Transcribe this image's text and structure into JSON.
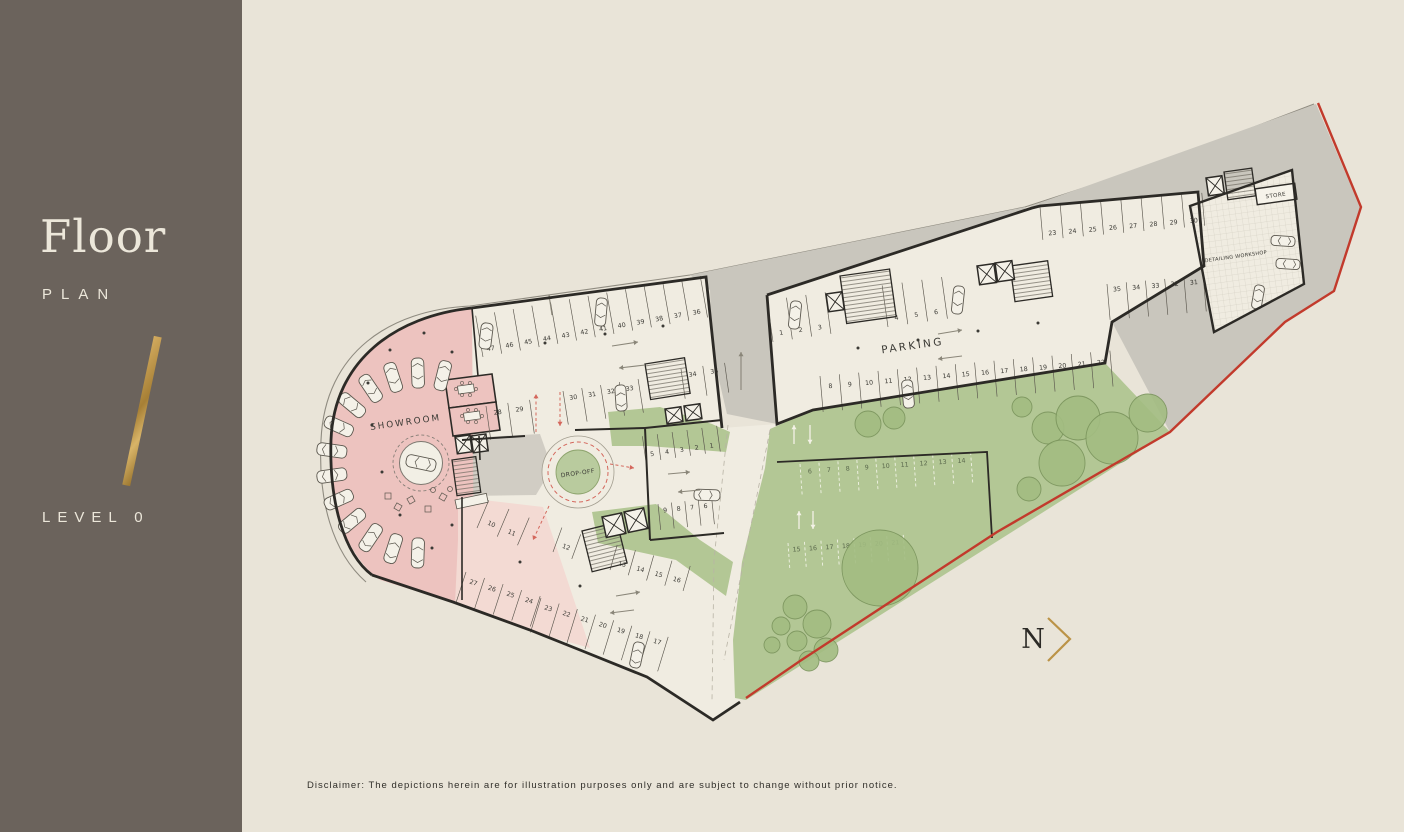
{
  "sidebar": {
    "title": "Floor",
    "subtitle": "PLAN",
    "level": "LEVEL 0"
  },
  "north": {
    "label": "N"
  },
  "disclaimer": "Disclaimer: The depictions herein are for illustration purposes only and are subject to change without prior notice.",
  "colors": {
    "sidebar_bg": "#6b635c",
    "sidebar_text": "#ece7da",
    "gold": "#bb9347",
    "canvas_bg": "#e9e4d8",
    "floor": "#f0ece1",
    "gray_zone": "#c9c6bd",
    "pink_strong": "#edc3bf",
    "pink_light": "#f3dad3",
    "green": "#b3c795",
    "green_island": "#b9cb9e",
    "tree_fill": "#a3bd82",
    "tree_stroke": "#7a945c",
    "wall": "#2c2a26",
    "line": "#5b574e",
    "car_fill": "#f4f1e8",
    "red_boundary": "#c23a2c",
    "red_dash": "#d4675c",
    "label_text": "#3b3a35",
    "arrow_gray": "#8a8679",
    "white_arrow": "#f4f2e7",
    "outdoor_num": "#5a684c",
    "site_line": "#8f8b80"
  },
  "plan": {
    "labels": {
      "showroom": "SHOWROOM",
      "dropoff": "DROP-OFF",
      "parking": "PARKING",
      "store": "STORE",
      "workshop": "DETAILING WORKSHOP"
    },
    "parking_rows": [
      {
        "numbers": [
          "47",
          "46",
          "45",
          "44",
          "43",
          "42",
          "41",
          "40",
          "39",
          "38",
          "37",
          "36"
        ],
        "x": 483,
        "y": 357,
        "angle": -10,
        "spacing": 19,
        "depth": 42,
        "side": -1,
        "inset": 7
      },
      {
        "numbers": [
          "28",
          "29"
        ],
        "x": 486,
        "y": 406,
        "angle": -8,
        "spacing": 22,
        "depth": 34,
        "side": 1,
        "inset": 8
      },
      {
        "numbers": [
          "30",
          "31",
          "32",
          "33"
        ],
        "x": 563,
        "y": 391,
        "angle": -9,
        "spacing": 19,
        "depth": 34,
        "side": 1,
        "inset": 8
      },
      {
        "numbers": [
          "34",
          "35"
        ],
        "x": 681,
        "y": 369,
        "angle": -8,
        "spacing": 22,
        "depth": 30,
        "side": 1,
        "inset": 7
      },
      {
        "numbers": [
          "5",
          "4",
          "3",
          "2",
          "1"
        ],
        "x": 646,
        "y": 462,
        "angle": -8,
        "spacing": 15,
        "depth": 26,
        "side": -1,
        "inset": 7
      },
      {
        "numbers": [
          "9",
          "8",
          "7",
          "6"
        ],
        "x": 658,
        "y": 504,
        "angle": -6,
        "spacing": 13.5,
        "depth": 26,
        "side": 1,
        "inset": 7
      },
      {
        "numbers": [
          "1",
          "2",
          "3"
        ],
        "x": 773,
        "y": 342,
        "angle": -8,
        "spacing": 19.5,
        "depth": 42,
        "side": -1,
        "inset": 8
      },
      {
        "numbers": [
          "4",
          "5",
          "6"
        ],
        "x": 888,
        "y": 327,
        "angle": -8,
        "spacing": 20,
        "depth": 42,
        "side": -1,
        "inset": 8
      },
      {
        "numbers": [
          "8",
          "9",
          "10",
          "11",
          "12",
          "13",
          "14",
          "15",
          "16",
          "17",
          "18",
          "19",
          "20",
          "21",
          "22"
        ],
        "x": 820,
        "y": 376,
        "angle": -5,
        "spacing": 19.4,
        "depth": 36,
        "side": 1,
        "inset": 11
      },
      {
        "numbers": [
          "23",
          "24",
          "25",
          "26",
          "27",
          "28",
          "29",
          "30"
        ],
        "x": 1040,
        "y": 207,
        "angle": -5,
        "spacing": 20.3,
        "depth": 33,
        "side": 1,
        "inset": 27
      },
      {
        "numbers": [
          "35",
          "34",
          "33",
          "32",
          "31"
        ],
        "x": 1107,
        "y": 284,
        "angle": -5,
        "spacing": 19.3,
        "depth": 36,
        "side": 1,
        "inset": 6
      },
      {
        "numbers": [
          "10",
          "11"
        ],
        "x": 477,
        "y": 528,
        "angle": 23,
        "spacing": 22,
        "depth": 30,
        "side": -1,
        "inset": 9
      },
      {
        "numbers": [
          "12"
        ],
        "x": 553,
        "y": 552,
        "angle": 20,
        "spacing": 20,
        "depth": 26,
        "side": -1,
        "inset": 9
      },
      {
        "numbers": [
          "13",
          "14",
          "15",
          "16"
        ],
        "x": 610,
        "y": 570,
        "angle": 16,
        "spacing": 19,
        "depth": 26,
        "side": -1,
        "inset": 9
      },
      {
        "numbers": [
          "27",
          "26",
          "25",
          "24"
        ],
        "x": 466,
        "y": 572,
        "angle": 18,
        "spacing": 19.5,
        "depth": 32,
        "side": 1,
        "inset": 8
      },
      {
        "numbers": [
          "23",
          "22",
          "21",
          "20",
          "19",
          "18",
          "17"
        ],
        "x": 541,
        "y": 598,
        "angle": 17,
        "spacing": 19,
        "depth": 36,
        "side": 1,
        "inset": 8
      }
    ],
    "outdoor_rows": [
      {
        "numbers": [
          "6",
          "7",
          "8",
          "9",
          "10",
          "11",
          "12",
          "13",
          "14"
        ],
        "x": 800,
        "y": 464,
        "angle": -4,
        "spacing": 19,
        "depth": 32,
        "side": 1,
        "inset": 8
      },
      {
        "numbers": [
          "15",
          "16",
          "17",
          "18",
          "19",
          "20",
          "21"
        ],
        "x": 788,
        "y": 543,
        "angle": -4,
        "spacing": 16.5,
        "depth": 26,
        "side": 1,
        "inset": 7
      }
    ],
    "showroom_display": {
      "center": [
        421,
        463
      ],
      "radius": 90,
      "angles": [
        284,
        268,
        252,
        236,
        220,
        204,
        188,
        172,
        156,
        140,
        124,
        108,
        92
      ],
      "turntable_radius": 21.5
    },
    "stall_cars": [
      [
        486,
        336,
        -83,
        26,
        12
      ],
      [
        601,
        312,
        -85,
        28,
        11
      ],
      [
        621,
        398,
        86,
        26,
        11
      ],
      [
        795,
        315,
        -84,
        28,
        11
      ],
      [
        958,
        300,
        -84,
        28,
        11
      ],
      [
        908,
        394,
        -95,
        28,
        11
      ],
      [
        707,
        495,
        182,
        26,
        11
      ],
      [
        637,
        655,
        102,
        26,
        11
      ],
      [
        1283,
        241,
        4,
        24,
        10
      ],
      [
        1288,
        264,
        4,
        24,
        10
      ],
      [
        1258,
        297,
        -80,
        24,
        10
      ]
    ],
    "trees": [
      [
        1022,
        407,
        10
      ],
      [
        1048,
        428,
        16
      ],
      [
        1078,
        418,
        22
      ],
      [
        1112,
        438,
        26
      ],
      [
        1148,
        413,
        19
      ],
      [
        1062,
        463,
        23
      ],
      [
        1029,
        489,
        12
      ],
      [
        868,
        424,
        13
      ],
      [
        894,
        418,
        11
      ],
      [
        880,
        568,
        38
      ],
      [
        795,
        607,
        12
      ],
      [
        817,
        624,
        14
      ],
      [
        797,
        641,
        10
      ],
      [
        826,
        650,
        12
      ],
      [
        781,
        626,
        9
      ],
      [
        809,
        661,
        10
      ],
      [
        772,
        645,
        8
      ]
    ]
  }
}
